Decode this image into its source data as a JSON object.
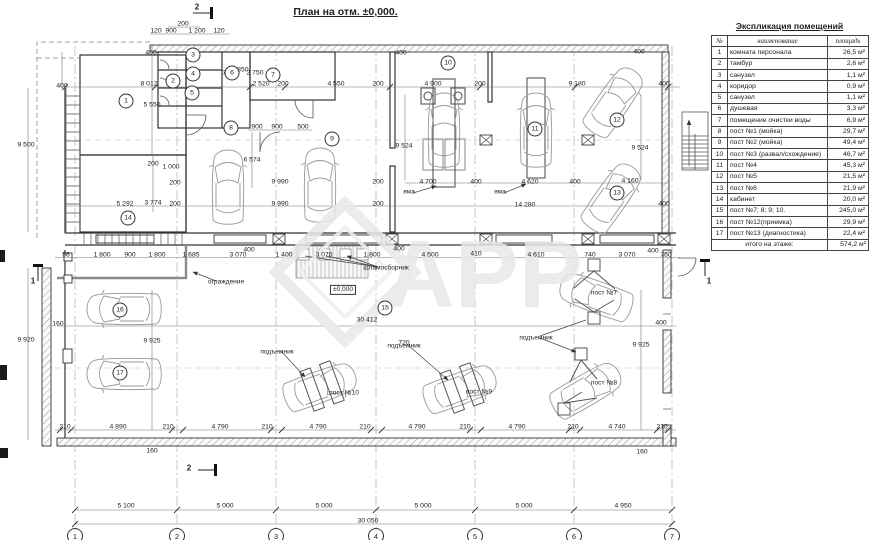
{
  "title": "План на отм. ±0,000.",
  "watermark": "APP",
  "legend": {
    "title": "Экспликация помещений",
    "columns": [
      "№",
      "наименование",
      "площадь"
    ],
    "rows": [
      [
        "1",
        "комната персонала",
        "26,5 м²"
      ],
      [
        "2",
        "тамбур",
        "2,6 м²"
      ],
      [
        "3",
        "санузел",
        "1,1 м²"
      ],
      [
        "4",
        "коридор",
        "0,9 м²"
      ],
      [
        "5",
        "санузел",
        "1,1 м²"
      ],
      [
        "6",
        "душевая",
        "3,3 м²"
      ],
      [
        "7",
        "помещение очистки воды",
        "6,9 м²"
      ],
      [
        "8",
        "пост №1 (мойка)",
        "29,7 м²"
      ],
      [
        "9",
        "пост №2 (мойка)",
        "49,4 м²"
      ],
      [
        "10",
        "пост №3 (развал/схождение)",
        "46,7 м²"
      ],
      [
        "11",
        "пост №4",
        "45,3 м²"
      ],
      [
        "12",
        "пост №5",
        "21,5 м²"
      ],
      [
        "13",
        "пост №6",
        "21,9 м²"
      ],
      [
        "14",
        "кабинет",
        "20,0 м²"
      ],
      [
        "15",
        "пост №7; 8; 9; 10.",
        "245,0 м²"
      ],
      [
        "16",
        "пост №12(приемка)",
        "29,9 м²"
      ],
      [
        "17",
        "пост №13 (диагностика)",
        "22,4 м²"
      ]
    ],
    "footer_label": "итого на этаже:",
    "footer_value": "574,2 м²"
  },
  "plan": {
    "axes": [
      {
        "n": "1",
        "x": 75
      },
      {
        "n": "2",
        "x": 177
      },
      {
        "n": "3",
        "x": 276
      },
      {
        "n": "4",
        "x": 376
      },
      {
        "n": "5",
        "x": 475
      },
      {
        "n": "6",
        "x": 574
      },
      {
        "n": "7",
        "x": 672
      }
    ],
    "rooms": [
      {
        "n": "1",
        "x": 126,
        "y": 101
      },
      {
        "n": "2",
        "x": 173,
        "y": 81
      },
      {
        "n": "3",
        "x": 193,
        "y": 55
      },
      {
        "n": "4",
        "x": 193,
        "y": 74
      },
      {
        "n": "5",
        "x": 192,
        "y": 93
      },
      {
        "n": "6",
        "x": 232,
        "y": 73
      },
      {
        "n": "7",
        "x": 273,
        "y": 75
      },
      {
        "n": "8",
        "x": 231,
        "y": 128
      },
      {
        "n": "9",
        "x": 332,
        "y": 139
      },
      {
        "n": "10",
        "x": 448,
        "y": 63
      },
      {
        "n": "11",
        "x": 535,
        "y": 129
      },
      {
        "n": "12",
        "x": 617,
        "y": 120
      },
      {
        "n": "13",
        "x": 617,
        "y": 193
      },
      {
        "n": "14",
        "x": 128,
        "y": 218
      },
      {
        "n": "15",
        "x": 385,
        "y": 308
      },
      {
        "n": "16",
        "x": 120,
        "y": 310
      },
      {
        "n": "17",
        "x": 120,
        "y": 373
      }
    ],
    "labels": [
      {
        "t": "ограждение",
        "x": 226,
        "y": 282
      },
      {
        "t": "шламосборник",
        "x": 386,
        "y": 268
      },
      {
        "t": "яма",
        "x": 409,
        "y": 192
      },
      {
        "t": "яма",
        "x": 500,
        "y": 192
      },
      {
        "t": "подъемник",
        "x": 277,
        "y": 352
      },
      {
        "t": "подъемник",
        "x": 404,
        "y": 346
      },
      {
        "t": "подъемник",
        "x": 536,
        "y": 338
      },
      {
        "t": "пост №10",
        "x": 344,
        "y": 393
      },
      {
        "t": "пост №9",
        "x": 479,
        "y": 392
      },
      {
        "t": "пост №8",
        "x": 604,
        "y": 383
      },
      {
        "t": "пост №7",
        "x": 604,
        "y": 293
      },
      {
        "t": "±0,000",
        "x": 343,
        "y": 290,
        "b": 1
      }
    ],
    "sections": [
      {
        "t": "2",
        "x": 197,
        "y": 7
      },
      {
        "t": "2",
        "x": 189,
        "y": 468
      },
      {
        "t": "1",
        "x": 33,
        "y": 281
      },
      {
        "t": "1",
        "x": 709,
        "y": 281
      }
    ],
    "dims": [
      {
        "t": "200",
        "x": 183,
        "y": 24
      },
      {
        "t": "120",
        "x": 156,
        "y": 31
      },
      {
        "t": "900",
        "x": 171,
        "y": 31
      },
      {
        "t": "1 200",
        "x": 197,
        "y": 31
      },
      {
        "t": "120",
        "x": 219,
        "y": 31
      },
      {
        "t": "8 012",
        "x": 149,
        "y": 84
      },
      {
        "t": "2 520",
        "x": 261,
        "y": 84
      },
      {
        "t": "200",
        "x": 283,
        "y": 84
      },
      {
        "t": "4 550",
        "x": 336,
        "y": 84
      },
      {
        "t": "200",
        "x": 378,
        "y": 84
      },
      {
        "t": "4 900",
        "x": 433,
        "y": 84
      },
      {
        "t": "200",
        "x": 480,
        "y": 84
      },
      {
        "t": "9 180",
        "x": 577,
        "y": 84
      },
      {
        "t": "400",
        "x": 664,
        "y": 84
      },
      {
        "t": "400",
        "x": 62,
        "y": 86,
        "r": 1
      },
      {
        "t": "9 500",
        "x": 26,
        "y": 145,
        "r": 1
      },
      {
        "t": "400",
        "x": 151,
        "y": 53,
        "r": 1
      },
      {
        "t": "5 550",
        "x": 152,
        "y": 105,
        "r": 1
      },
      {
        "t": "710",
        "x": 228,
        "y": 73,
        "r": 1
      },
      {
        "t": "2 850",
        "x": 240,
        "y": 70,
        "r": 1
      },
      {
        "t": "2 750",
        "x": 255,
        "y": 73,
        "r": 1
      },
      {
        "t": "400",
        "x": 401,
        "y": 53,
        "r": 1
      },
      {
        "t": "400",
        "x": 639,
        "y": 52,
        "r": 1
      },
      {
        "t": "9 524",
        "x": 404,
        "y": 146,
        "r": 1
      },
      {
        "t": "9 524",
        "x": 640,
        "y": 148,
        "r": 1
      },
      {
        "t": "900",
        "x": 257,
        "y": 127
      },
      {
        "t": "900",
        "x": 277,
        "y": 127
      },
      {
        "t": "500",
        "x": 303,
        "y": 127
      },
      {
        "t": "200",
        "x": 153,
        "y": 164,
        "r": 1
      },
      {
        "t": "1 000",
        "x": 171,
        "y": 167,
        "r": 1
      },
      {
        "t": "6 574",
        "x": 252,
        "y": 160,
        "r": 1
      },
      {
        "t": "3 774",
        "x": 153,
        "y": 203,
        "r": 1
      },
      {
        "t": "5 292",
        "x": 125,
        "y": 204
      },
      {
        "t": "200",
        "x": 175,
        "y": 183
      },
      {
        "t": "200",
        "x": 175,
        "y": 204
      },
      {
        "t": "9 990",
        "x": 280,
        "y": 182
      },
      {
        "t": "200",
        "x": 378,
        "y": 182
      },
      {
        "t": "9 990",
        "x": 280,
        "y": 204
      },
      {
        "t": "200",
        "x": 378,
        "y": 204
      },
      {
        "t": "4 700",
        "x": 428,
        "y": 182
      },
      {
        "t": "400",
        "x": 476,
        "y": 182
      },
      {
        "t": "4 620",
        "x": 530,
        "y": 182
      },
      {
        "t": "400",
        "x": 575,
        "y": 182
      },
      {
        "t": "4 160",
        "x": 630,
        "y": 181
      },
      {
        "t": "400",
        "x": 664,
        "y": 204
      },
      {
        "t": "14 280",
        "x": 525,
        "y": 205
      },
      {
        "t": "56",
        "x": 66,
        "y": 255
      },
      {
        "t": "1 800",
        "x": 102,
        "y": 255
      },
      {
        "t": "900",
        "x": 130,
        "y": 255
      },
      {
        "t": "1 800",
        "x": 157,
        "y": 255
      },
      {
        "t": "1 685",
        "x": 191,
        "y": 255
      },
      {
        "t": "3 070",
        "x": 238,
        "y": 255
      },
      {
        "t": "1 400",
        "x": 284,
        "y": 255
      },
      {
        "t": "400",
        "x": 249,
        "y": 250,
        "r": 1
      },
      {
        "t": "3 070",
        "x": 324,
        "y": 255
      },
      {
        "t": "1 800",
        "x": 372,
        "y": 255
      },
      {
        "t": "400",
        "x": 399,
        "y": 249,
        "r": 1
      },
      {
        "t": "4 500",
        "x": 430,
        "y": 255
      },
      {
        "t": "410",
        "x": 476,
        "y": 254
      },
      {
        "t": "4 610",
        "x": 536,
        "y": 255
      },
      {
        "t": "740",
        "x": 590,
        "y": 255
      },
      {
        "t": "3 070",
        "x": 627,
        "y": 255
      },
      {
        "t": "400",
        "x": 653,
        "y": 251,
        "r": 1
      },
      {
        "t": "750",
        "x": 666,
        "y": 255
      },
      {
        "t": "160",
        "x": 58,
        "y": 324,
        "r": 1
      },
      {
        "t": "9 920",
        "x": 26,
        "y": 340,
        "r": 1
      },
      {
        "t": "9 925",
        "x": 152,
        "y": 341,
        "r": 1
      },
      {
        "t": "720",
        "x": 404,
        "y": 343,
        "r": 1
      },
      {
        "t": "9 925",
        "x": 641,
        "y": 345,
        "r": 1
      },
      {
        "t": "30 412",
        "x": 367,
        "y": 320
      },
      {
        "t": "400",
        "x": 661,
        "y": 323
      },
      {
        "t": "210",
        "x": 65,
        "y": 427
      },
      {
        "t": "4 890",
        "x": 118,
        "y": 427
      },
      {
        "t": "210",
        "x": 168,
        "y": 427
      },
      {
        "t": "4 790",
        "x": 220,
        "y": 427
      },
      {
        "t": "210",
        "x": 267,
        "y": 427
      },
      {
        "t": "4 790",
        "x": 318,
        "y": 427
      },
      {
        "t": "210",
        "x": 365,
        "y": 427
      },
      {
        "t": "4 790",
        "x": 417,
        "y": 427
      },
      {
        "t": "210",
        "x": 465,
        "y": 427
      },
      {
        "t": "4 790",
        "x": 517,
        "y": 427
      },
      {
        "t": "210",
        "x": 573,
        "y": 427
      },
      {
        "t": "4 740",
        "x": 617,
        "y": 427
      },
      {
        "t": "210",
        "x": 662,
        "y": 427
      },
      {
        "t": "160",
        "x": 152,
        "y": 451,
        "r": 1
      },
      {
        "t": "160",
        "x": 642,
        "y": 452,
        "r": 1
      },
      {
        "t": "5 100",
        "x": 126,
        "y": 506
      },
      {
        "t": "5 000",
        "x": 225,
        "y": 506
      },
      {
        "t": "5 000",
        "x": 324,
        "y": 506
      },
      {
        "t": "5 000",
        "x": 423,
        "y": 506
      },
      {
        "t": "5 000",
        "x": 524,
        "y": 506
      },
      {
        "t": "4 950",
        "x": 623,
        "y": 506
      },
      {
        "t": "30 050",
        "x": 368,
        "y": 521
      }
    ]
  }
}
